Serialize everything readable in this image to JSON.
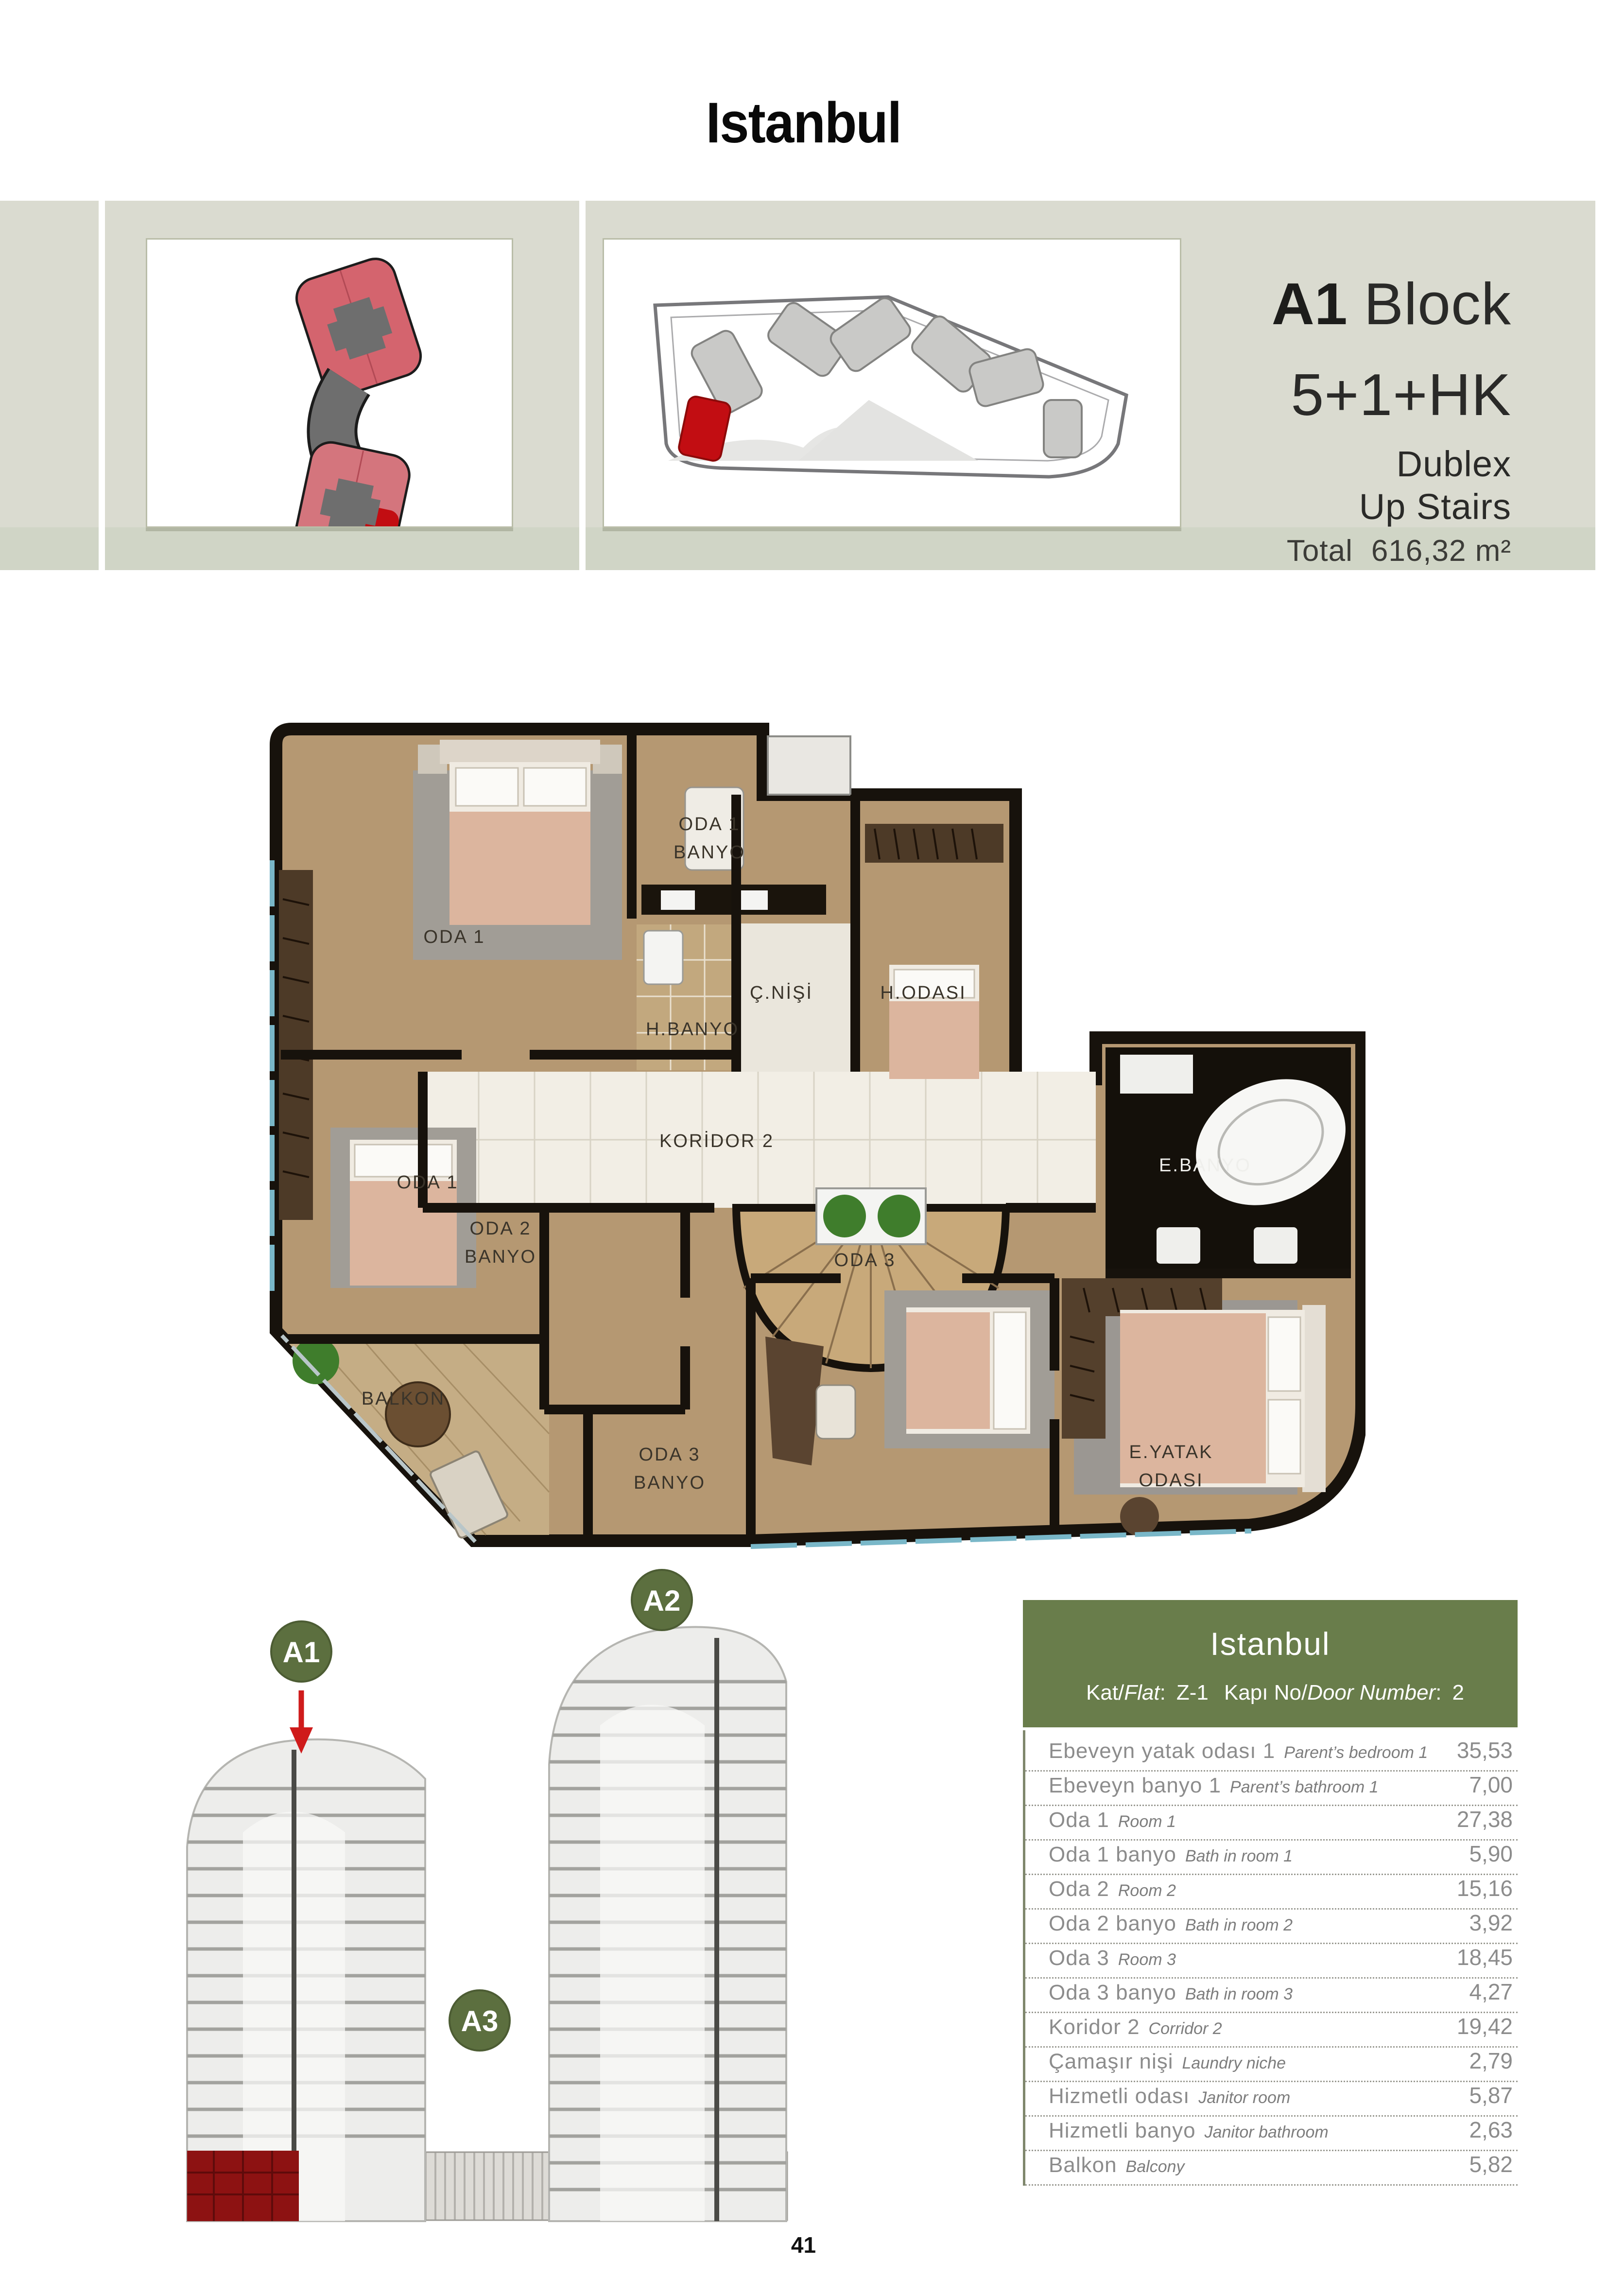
{
  "page": {
    "title": "Istanbul",
    "number": "41"
  },
  "info": {
    "block_bold": "A1",
    "block_light": "Block",
    "type": "5+1+HK",
    "style": "Dublex",
    "stairs": "Up Stairs",
    "total_label": "Total",
    "total_value": "616,32 m²"
  },
  "plan": {
    "labels": {
      "oda1_banyo_l1": "ODA 1",
      "oda1_banyo_l2": "BANYO",
      "oda1_top": "ODA 1",
      "c_nisi": "Ç.NİŞİ",
      "h_banyo": "H.BANYO",
      "h_odasi": "H.ODASI",
      "koridor2": "KORİDOR 2",
      "e_banyo": "E.BANYO",
      "oda1_mid": "ODA 1",
      "oda2_banyo_l1": "ODA 2",
      "oda2_banyo_l2": "BANYO",
      "balkon": "BALKON",
      "oda3_banyo_l1": "ODA 3",
      "oda3_banyo_l2": "BANYO",
      "oda3": "ODA 3",
      "e_yatak_l1": "E.YATAK",
      "e_yatak_l2": "ODASI"
    }
  },
  "towers": {
    "a1": "A1",
    "a2": "A2",
    "a3": "A3"
  },
  "table": {
    "title": "Istanbul",
    "flat_prefix": "Kat/",
    "flat_italic": "Flat",
    "flat_colon": ":",
    "flat_value": "Z-1",
    "door_prefix": "Kapı No/",
    "door_italic": "Door Number",
    "door_colon": ":",
    "door_value": "2",
    "rows": [
      {
        "tr": "Ebeveyn yatak odası 1",
        "en": "Parent’s bedroom 1",
        "value": "35,53"
      },
      {
        "tr": "Ebeveyn banyo 1",
        "en": "Parent’s bathroom 1",
        "value": "7,00"
      },
      {
        "tr": "Oda 1",
        "en": "Room 1",
        "value": "27,38"
      },
      {
        "tr": "Oda 1 banyo",
        "en": "Bath in room 1",
        "value": "5,90"
      },
      {
        "tr": "Oda 2",
        "en": "Room 2",
        "value": "15,16"
      },
      {
        "tr": "Oda 2 banyo",
        "en": "Bath in room 2",
        "value": "3,92"
      },
      {
        "tr": "Oda 3",
        "en": "Room 3",
        "value": "18,45"
      },
      {
        "tr": "Oda 3 banyo",
        "en": "Bath in room 3",
        "value": "4,27"
      },
      {
        "tr": "Koridor 2",
        "en": "Corridor 2",
        "value": "19,42"
      },
      {
        "tr": "Çamaşır nişi",
        "en": "Laundry niche",
        "value": "2,79"
      },
      {
        "tr": "Hizmetli odası",
        "en": "Janitor room",
        "value": "5,87"
      },
      {
        "tr": "Hizmetli banyo",
        "en": "Janitor bathroom",
        "value": "2,63"
      },
      {
        "tr": "Balkon",
        "en": "Balcony",
        "value": "5,82"
      }
    ]
  },
  "colors": {
    "band_beige": "#dadbd0",
    "total_band": "#d0d5c6",
    "header_green": "#697d4b",
    "badge_green": "#5c6f3f",
    "highlight_red": "#c20d12",
    "footprint_pink": "#d4646e",
    "wood": "#b59872",
    "marble": "#f2eee5"
  }
}
